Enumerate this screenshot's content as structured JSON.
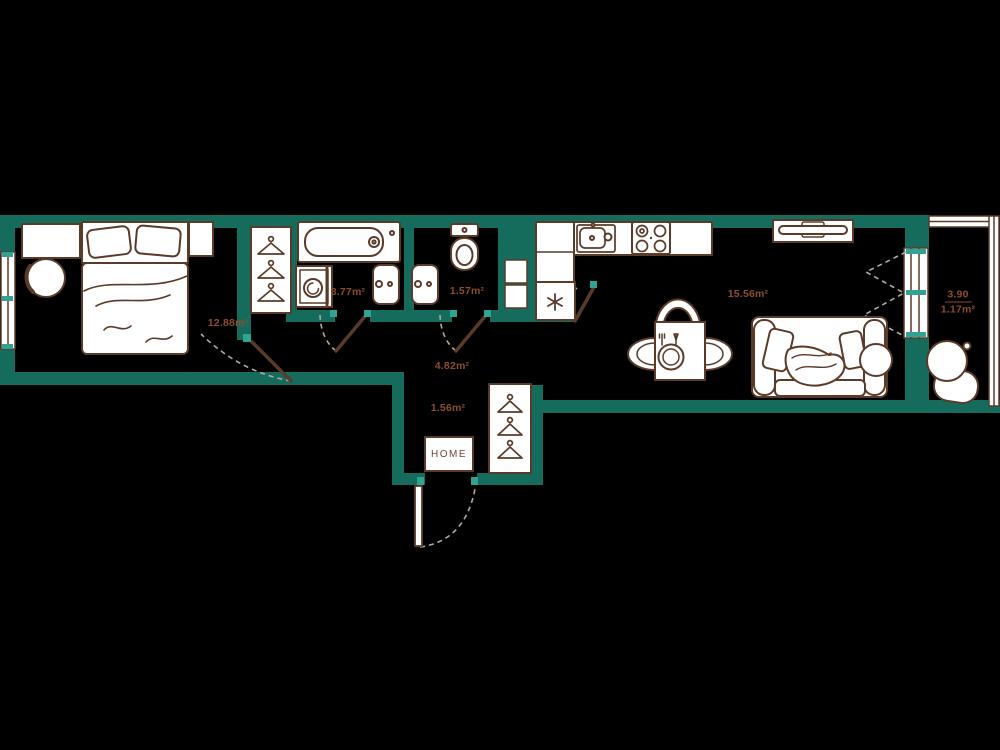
{
  "plan": {
    "doormat_text": "HOME",
    "rooms": {
      "bedroom": {
        "area": "12.88m²"
      },
      "bathroom": {
        "area": "3.77m²"
      },
      "wc": {
        "area": "1.57m²"
      },
      "kitchen_living": {
        "area": "15.56m²"
      },
      "hall": {
        "area": "4.82m²"
      },
      "entry": {
        "area": "1.56m²"
      },
      "balcony": {
        "area_total": "3.90",
        "area_reduced": "1.17m²"
      }
    },
    "colors": {
      "background": "#000000",
      "wall": "#156B5C",
      "accent": "#2FA493",
      "outline": "#5A3A28",
      "label_text": "#8C4D2E",
      "furniture_fill": "#FFFFFF",
      "door_swing_dash": "#B3AAA1"
    },
    "furniture": [
      "bed",
      "desk",
      "desk chair",
      "nightstand",
      "wardrobe with hangers",
      "bathtub",
      "washing machine",
      "bathroom sink",
      "toilet",
      "wc sink",
      "kitchen cabinets",
      "kitchen sink",
      "stove",
      "fridge",
      "dining table with plate and cutlery",
      "dining chairs",
      "tv stand",
      "sofa",
      "coffee table",
      "balcony chair",
      "entry wardrobe with hangers",
      "doormat"
    ]
  }
}
